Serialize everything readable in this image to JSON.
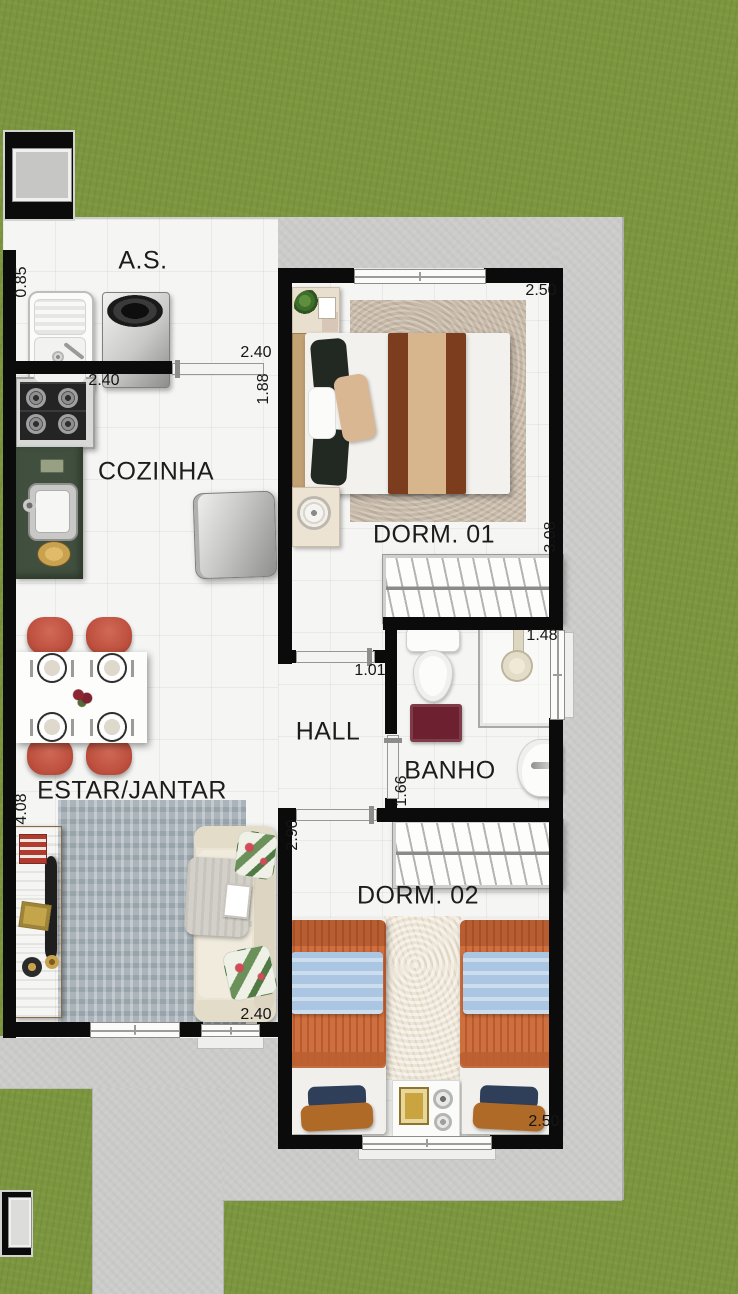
{
  "plan": {
    "type": "residential-floor-plan",
    "unit": "m",
    "rooms": {
      "as": {
        "label": "A.S."
      },
      "cozinha": {
        "label": "COZINHA"
      },
      "dorm01": {
        "label": "DORM. 01"
      },
      "hall": {
        "label": "HALL"
      },
      "banho": {
        "label": "BANHO"
      },
      "estar_jantar": {
        "label": "ESTAR/JANTAR"
      },
      "dorm02": {
        "label": "DORM. 02"
      }
    },
    "dimensions": {
      "as_entry": "0.85",
      "as_width": "2.40",
      "cozinha_width": "2.40",
      "cozinha_depth": "1.88",
      "dorm01_width": "2.50",
      "dorm01_length": "3.08",
      "hall_width": "1.01",
      "banho_width": "1.48",
      "banho_length": "1.66",
      "estar_length": "4.08",
      "dorm02_length": "2.90",
      "estar_width": "2.40",
      "dorm02_width": "2.50"
    },
    "furniture": {
      "as": [
        "laundry-tub",
        "washing-machine"
      ],
      "cozinha": [
        "stove",
        "green-counter-with-sink",
        "refrigerator"
      ],
      "dorm01": [
        "double-bed",
        "nightstand-with-plant",
        "nightstand-with-lamp",
        "rug",
        "wardrobe"
      ],
      "banho": [
        "toilet",
        "shower-box",
        "bath-mat",
        "washbasin"
      ],
      "estar_jantar": [
        "dining-table-4-seats",
        "red-chairs",
        "tv-rack",
        "tv",
        "rug",
        "sofa"
      ],
      "dorm02": [
        "wardrobe",
        "twin-bed-left",
        "twin-bed-right",
        "rug",
        "nightstand"
      ]
    }
  },
  "colors": {
    "grass": "#7c9640",
    "concrete": "#cccccb",
    "floor_tile": "#f5f5f3",
    "wall": "#0b0b0b",
    "counter_green": "#41503e",
    "chair_red": "#bf5140",
    "bath_mat_red": "#6d2130",
    "bedding_orange": "#cd6f3e",
    "blanket_blue": "#aac6e2",
    "sofa_cream": "#eae4d4",
    "wood": "#b2895b"
  }
}
